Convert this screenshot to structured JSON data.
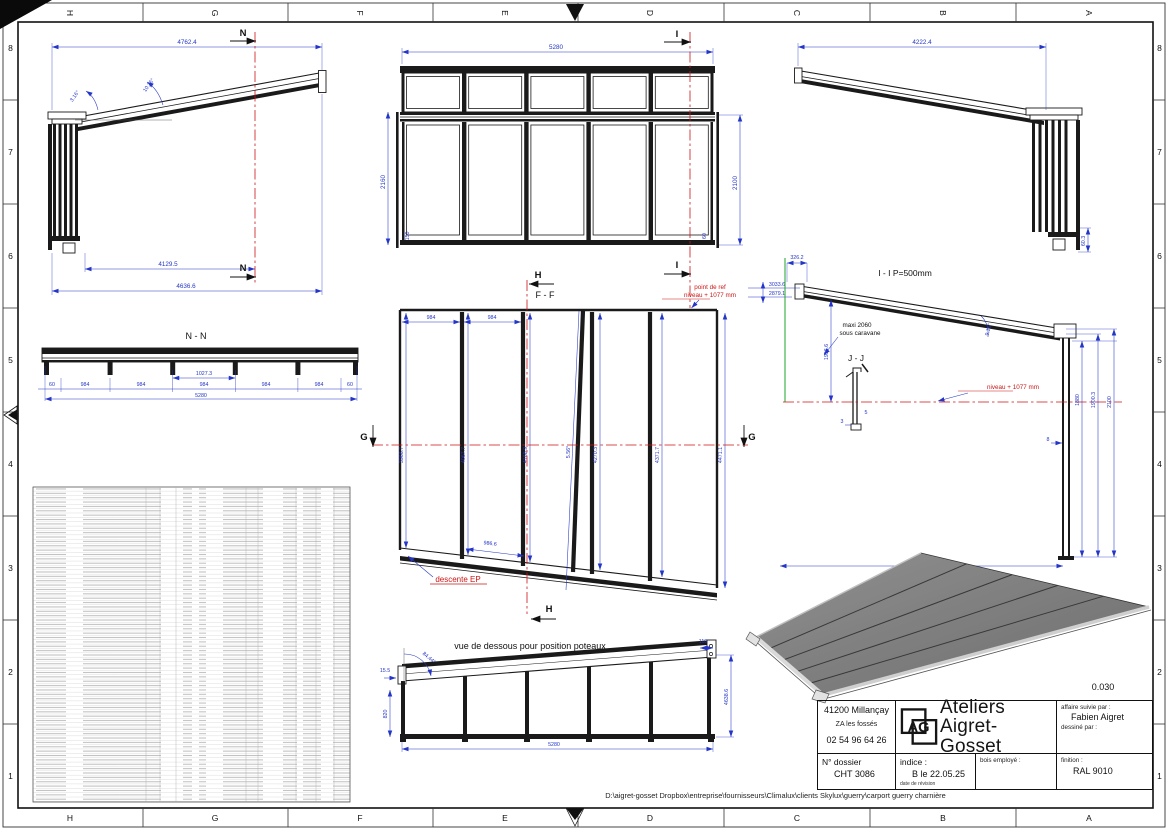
{
  "colors": {
    "dimension": "#2436c7",
    "section_line": "#cc1515",
    "aux_green": "#1ea32a",
    "linework": "#1a1a1a"
  },
  "sheet": {
    "grid_cols": [
      "H",
      "G",
      "F",
      "E",
      "D",
      "C",
      "B",
      "A"
    ],
    "grid_rows": [
      "8",
      "7",
      "6",
      "5",
      "4",
      "3",
      "2",
      "1"
    ],
    "footer_path": "D:\\aigret-gosset Dropbox\\entreprise\\fournisseurs\\Climalux\\clients Skylux\\guerry\\carport guerry charnière"
  },
  "side_left": {
    "dim_top": "4762.4",
    "angle_low": "3.16°",
    "angle_high": "10.36°",
    "dim_inner": "4129.5",
    "dim_total": "4636.6",
    "marker": "N"
  },
  "front": {
    "dim_width": "5280",
    "dim_height_left": "2160",
    "dim_height_right": "2100",
    "dim_base_left": "150",
    "dim_base_right": "60",
    "marker_i": "I"
  },
  "side_right": {
    "dim_top": "4222.4",
    "dim_foot": "60.3",
    "section_label": "I - I P=500mm"
  },
  "section_nn": {
    "title": "N - N",
    "dim_end": "60",
    "dim_bay": "984",
    "dim_mid": "1027.3",
    "dim_total": "5280"
  },
  "plan_ff": {
    "title": "F - F",
    "ref_line1": "point de ref",
    "ref_line2": "niveau + 1077 mm",
    "dim_bay": "984",
    "lengths": [
      "3966.7",
      "4067.7",
      "4168.9",
      "4270.3",
      "4371.7",
      "4471.1"
    ],
    "angle": "5.56°",
    "dim_drop": "986.6",
    "descente": "descente EP",
    "marker_g": "G",
    "marker_h": "H"
  },
  "section_ii": {
    "dim_a": "3033.6",
    "dim_b": "2879.1",
    "dim_c": "326.2",
    "dim_green": "1956.6",
    "note1": "maxi 2060",
    "note2": "sous caravane",
    "detail": "J - J",
    "d5": "5",
    "d3": "3",
    "level": "niveau + 1077 mm",
    "angle": "9.16°",
    "h1": "1880",
    "h2": "1900.3",
    "h3": "2100",
    "d8": "8"
  },
  "bottom_view": {
    "caption": "vue de dessous pour position poteaux",
    "dim_155": "15.5",
    "angle": "84.44°",
    "dim_820": "820",
    "dim_width": "5280",
    "dim_height": "4638.6",
    "dim_110": "110"
  },
  "title_block": {
    "city": "41200 Millançay",
    "zone": "ZA les fossés",
    "phone": "02 54 96 64 26",
    "logo": "AG",
    "company1": "Ateliers",
    "company2": "Aigret-Gosset",
    "scale": "0.030",
    "affaire_label": "affaire suivie par :",
    "affaire": "Fabien Aigret",
    "dessine_label": "dessiné par :",
    "dossier_label": "N° dossier",
    "dossier": "CHT 3086",
    "indice_label": "indice :",
    "indice": "B le 22.05.25",
    "revision_label": "date de révision",
    "bois_label": "bois employé :",
    "finition_label": "finition :",
    "finition": "RAL 9010"
  }
}
